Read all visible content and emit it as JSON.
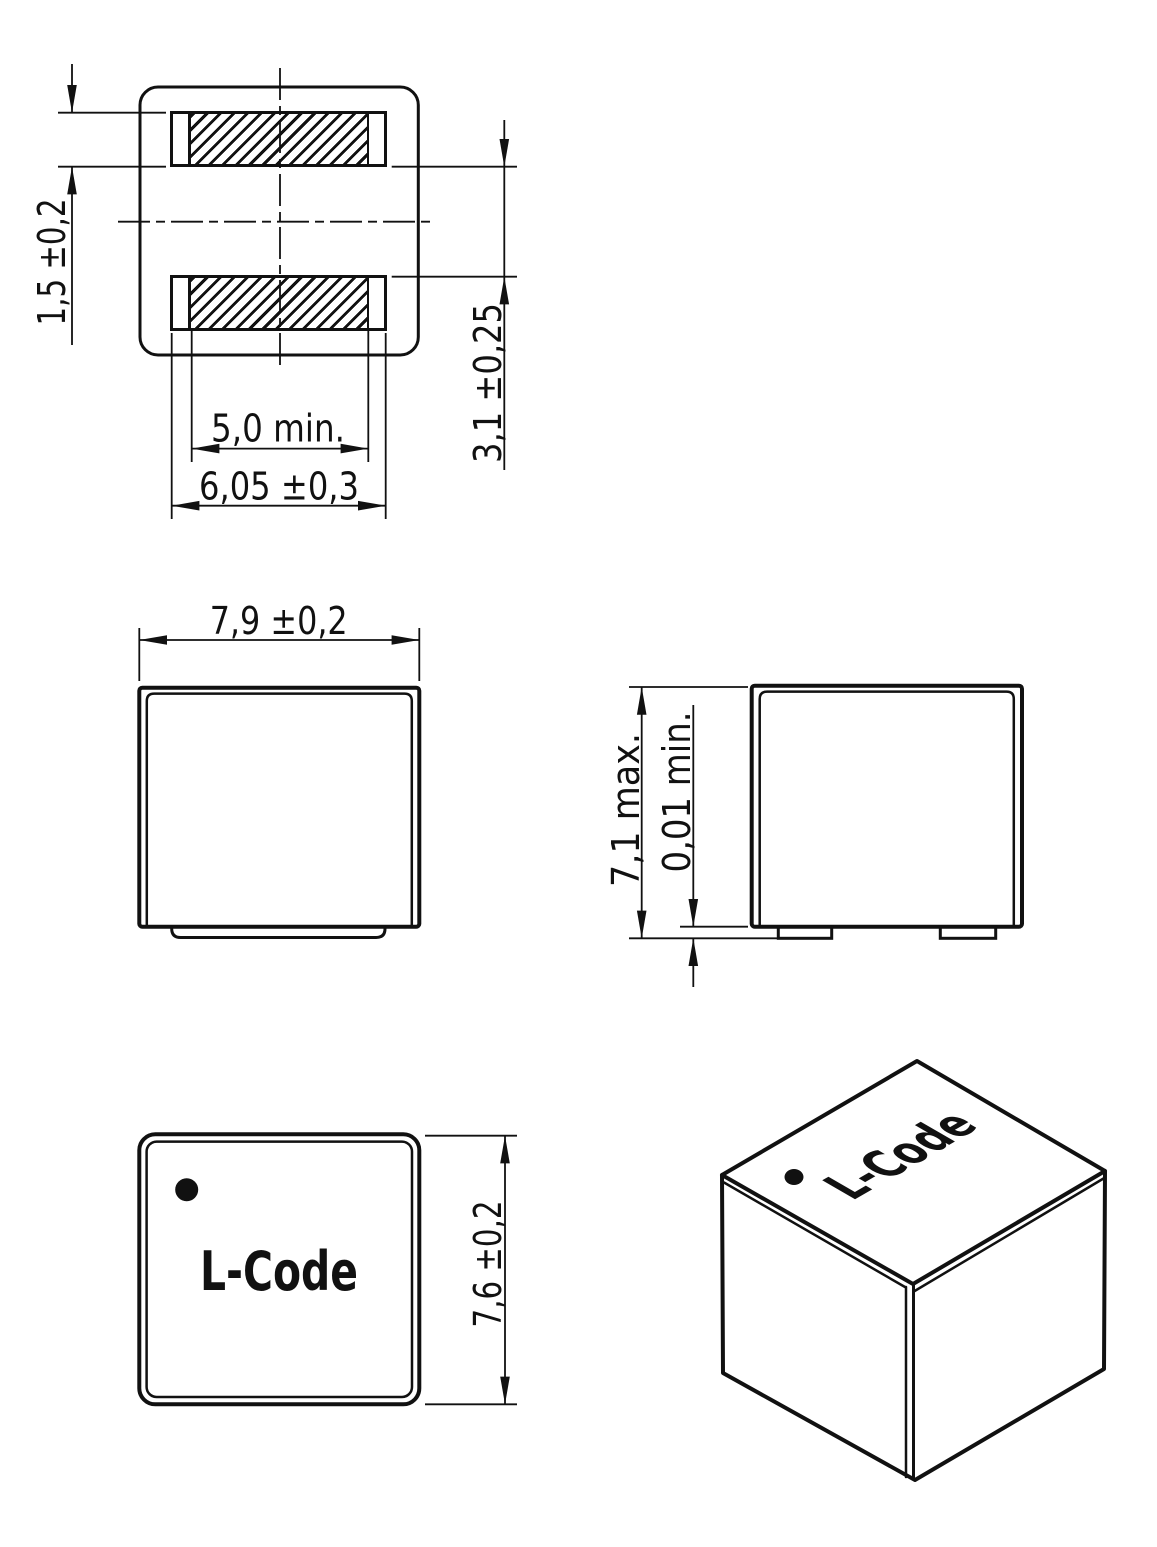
{
  "colors": {
    "ink": "#111111",
    "paper": "#ffffff"
  },
  "views": {
    "land_pattern": {
      "pad_height": "1,5 ±0,2",
      "pad_gap": "3,1 ±0,25",
      "hatched_width": "5,0 min.",
      "pad_width": "6,05 ±0,3"
    },
    "front": {
      "width": "7,9 ±0,2"
    },
    "side": {
      "height": "7,1 max.",
      "standoff": "0,01 min."
    },
    "top": {
      "depth": "7,6 ±0,2",
      "marking": "L-Code"
    },
    "isometric": {
      "marking": "L-Code"
    }
  }
}
